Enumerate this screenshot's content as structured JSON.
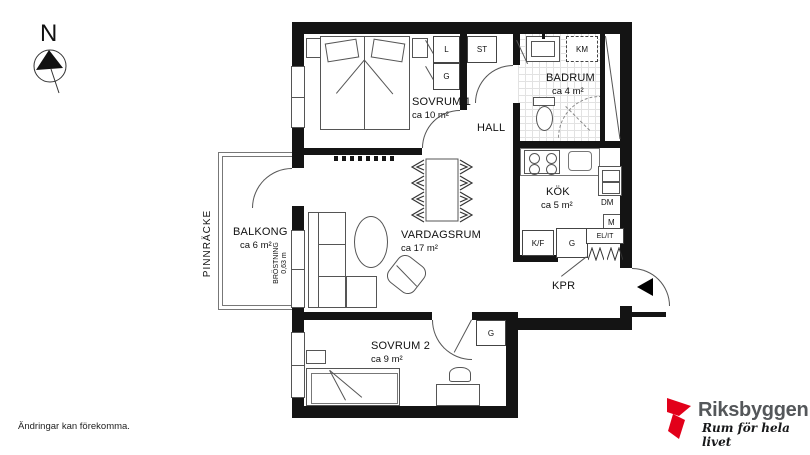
{
  "compass": {
    "north_label": "N"
  },
  "rooms": {
    "sovrum1": {
      "name": "SOVRUM 1",
      "area": "ca 10 m²"
    },
    "hall": {
      "name": "HALL"
    },
    "badrum": {
      "name": "BADRUM",
      "area": "ca 4 m²"
    },
    "kok": {
      "name": "KÖK",
      "area": "ca 5 m²"
    },
    "vardagsrum": {
      "name": "VARDAGSRUM",
      "area": "ca 17 m²"
    },
    "kpr": {
      "name": "KPR"
    },
    "sovrum2": {
      "name": "SOVRUM 2",
      "area": "ca 9 m²"
    },
    "balkong": {
      "name": "BALKONG",
      "area": "ca 6 m²"
    }
  },
  "annotations": {
    "railing": "PINNRÄCKE",
    "parapet": "BRÖSTNING",
    "parapet_height": "0,63 m",
    "disclaimer": "Ändringar kan förekomma."
  },
  "fixtures": {
    "linen_closet": "L",
    "wardrobe_sovrum1": "G",
    "cleaning_closet": "ST",
    "washing_machine": "KM",
    "dishwasher": "DM",
    "micro": "M",
    "fridge_freezer": "K/F",
    "wardrobe_kpr": "G",
    "electrical": "EL/IT",
    "wardrobe_sovrum2": "G"
  },
  "logo": {
    "brand": "Riksbyggen",
    "tagline": "Rum för hela livet",
    "brand_color": "#e2001a"
  }
}
